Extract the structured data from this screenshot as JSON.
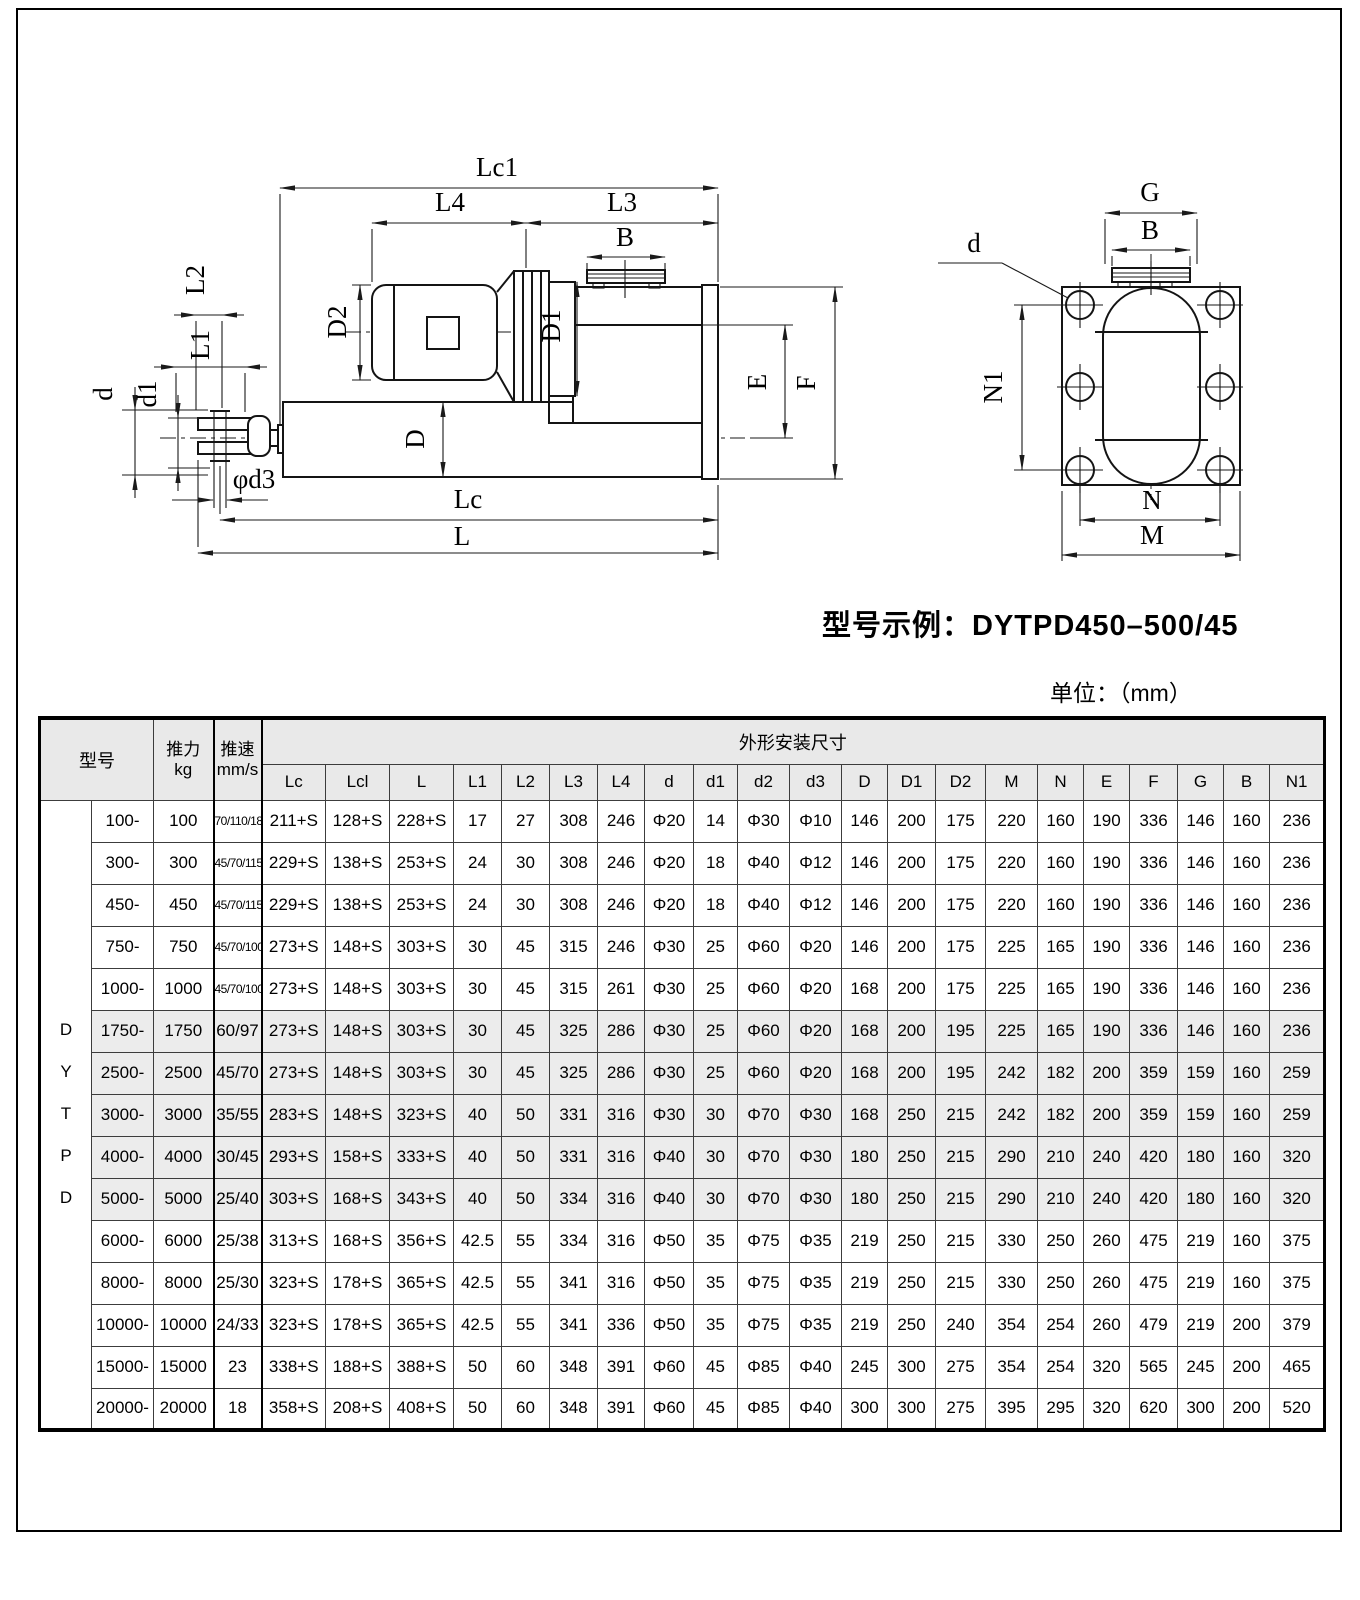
{
  "page": {
    "model_example": "型号示例：DYTPD450–500/45",
    "unit_note": "单位：（mm）"
  },
  "drawing": {
    "side": {
      "lc1": "Lc1",
      "l4": "L4",
      "l3": "L3",
      "b": "B",
      "d2": "D2",
      "dd1": "D1",
      "dd": "D",
      "l2": "L2",
      "l1": "L1",
      "d": "d",
      "d1": "d1",
      "phid3": "φd3",
      "e": "E",
      "f": "F",
      "lc": "Lc",
      "l": "L"
    },
    "end": {
      "g": "G",
      "b": "B",
      "d": "d",
      "n1": "N1",
      "n": "N",
      "m": "M"
    }
  },
  "table": {
    "series_vertical": [
      "D",
      "Y",
      "T",
      "P",
      "D"
    ],
    "headers": {
      "model": "型号",
      "thrust_line1": "推力",
      "thrust_line2": "kg",
      "speed_line1": "推速",
      "speed_line2": "mm/s",
      "dims_group": "外形安装尺寸",
      "dims": [
        "Lc",
        "Lcl",
        "L",
        "L1",
        "L2",
        "L3",
        "L4",
        "d",
        "d1",
        "d2",
        "d3",
        "D",
        "D1",
        "D2",
        "M",
        "N",
        "E",
        "F",
        "G",
        "B",
        "N1"
      ]
    },
    "rows": [
      {
        "model": "100-",
        "thrust": "100",
        "speed": "70/110/185",
        "shaded": false,
        "dims": [
          "211+S",
          "128+S",
          "228+S",
          "17",
          "27",
          "308",
          "246",
          "Φ20",
          "14",
          "Φ30",
          "Φ10",
          "146",
          "200",
          "175",
          "220",
          "160",
          "190",
          "336",
          "146",
          "160",
          "236"
        ]
      },
      {
        "model": "300-",
        "thrust": "300",
        "speed": "45/70/115",
        "shaded": false,
        "dims": [
          "229+S",
          "138+S",
          "253+S",
          "24",
          "30",
          "308",
          "246",
          "Φ20",
          "18",
          "Φ40",
          "Φ12",
          "146",
          "200",
          "175",
          "220",
          "160",
          "190",
          "336",
          "146",
          "160",
          "236"
        ]
      },
      {
        "model": "450-",
        "thrust": "450",
        "speed": "45/70/115",
        "shaded": false,
        "dims": [
          "229+S",
          "138+S",
          "253+S",
          "24",
          "30",
          "308",
          "246",
          "Φ20",
          "18",
          "Φ40",
          "Φ12",
          "146",
          "200",
          "175",
          "220",
          "160",
          "190",
          "336",
          "146",
          "160",
          "236"
        ]
      },
      {
        "model": "750-",
        "thrust": "750",
        "speed": "45/70/100",
        "shaded": false,
        "dims": [
          "273+S",
          "148+S",
          "303+S",
          "30",
          "45",
          "315",
          "246",
          "Φ30",
          "25",
          "Φ60",
          "Φ20",
          "146",
          "200",
          "175",
          "225",
          "165",
          "190",
          "336",
          "146",
          "160",
          "236"
        ]
      },
      {
        "model": "1000-",
        "thrust": "1000",
        "speed": "45/70/100",
        "shaded": false,
        "dims": [
          "273+S",
          "148+S",
          "303+S",
          "30",
          "45",
          "315",
          "261",
          "Φ30",
          "25",
          "Φ60",
          "Φ20",
          "168",
          "200",
          "175",
          "225",
          "165",
          "190",
          "336",
          "146",
          "160",
          "236"
        ]
      },
      {
        "model": "1750-",
        "thrust": "1750",
        "speed": "60/97",
        "shaded": true,
        "dims": [
          "273+S",
          "148+S",
          "303+S",
          "30",
          "45",
          "325",
          "286",
          "Φ30",
          "25",
          "Φ60",
          "Φ20",
          "168",
          "200",
          "195",
          "225",
          "165",
          "190",
          "336",
          "146",
          "160",
          "236"
        ]
      },
      {
        "model": "2500-",
        "thrust": "2500",
        "speed": "45/70",
        "shaded": true,
        "dims": [
          "273+S",
          "148+S",
          "303+S",
          "30",
          "45",
          "325",
          "286",
          "Φ30",
          "25",
          "Φ60",
          "Φ20",
          "168",
          "200",
          "195",
          "242",
          "182",
          "200",
          "359",
          "159",
          "160",
          "259"
        ]
      },
      {
        "model": "3000-",
        "thrust": "3000",
        "speed": "35/55",
        "shaded": true,
        "dims": [
          "283+S",
          "148+S",
          "323+S",
          "40",
          "50",
          "331",
          "316",
          "Φ30",
          "30",
          "Φ70",
          "Φ30",
          "168",
          "250",
          "215",
          "242",
          "182",
          "200",
          "359",
          "159",
          "160",
          "259"
        ]
      },
      {
        "model": "4000-",
        "thrust": "4000",
        "speed": "30/45",
        "shaded": true,
        "dims": [
          "293+S",
          "158+S",
          "333+S",
          "40",
          "50",
          "331",
          "316",
          "Φ40",
          "30",
          "Φ70",
          "Φ30",
          "180",
          "250",
          "215",
          "290",
          "210",
          "240",
          "420",
          "180",
          "160",
          "320"
        ]
      },
      {
        "model": "5000-",
        "thrust": "5000",
        "speed": "25/40",
        "shaded": true,
        "dims": [
          "303+S",
          "168+S",
          "343+S",
          "40",
          "50",
          "334",
          "316",
          "Φ40",
          "30",
          "Φ70",
          "Φ30",
          "180",
          "250",
          "215",
          "290",
          "210",
          "240",
          "420",
          "180",
          "160",
          "320"
        ]
      },
      {
        "model": "6000-",
        "thrust": "6000",
        "speed": "25/38",
        "shaded": false,
        "dims": [
          "313+S",
          "168+S",
          "356+S",
          "42.5",
          "55",
          "334",
          "316",
          "Φ50",
          "35",
          "Φ75",
          "Φ35",
          "219",
          "250",
          "215",
          "330",
          "250",
          "260",
          "475",
          "219",
          "160",
          "375"
        ]
      },
      {
        "model": "8000-",
        "thrust": "8000",
        "speed": "25/30",
        "shaded": false,
        "dims": [
          "323+S",
          "178+S",
          "365+S",
          "42.5",
          "55",
          "341",
          "316",
          "Φ50",
          "35",
          "Φ75",
          "Φ35",
          "219",
          "250",
          "215",
          "330",
          "250",
          "260",
          "475",
          "219",
          "160",
          "375"
        ]
      },
      {
        "model": "10000-",
        "thrust": "10000",
        "speed": "24/33",
        "shaded": false,
        "dims": [
          "323+S",
          "178+S",
          "365+S",
          "42.5",
          "55",
          "341",
          "336",
          "Φ50",
          "35",
          "Φ75",
          "Φ35",
          "219",
          "250",
          "240",
          "354",
          "254",
          "260",
          "479",
          "219",
          "200",
          "379"
        ]
      },
      {
        "model": "15000-",
        "thrust": "15000",
        "speed": "23",
        "shaded": false,
        "dims": [
          "338+S",
          "188+S",
          "388+S",
          "50",
          "60",
          "348",
          "391",
          "Φ60",
          "45",
          "Φ85",
          "Φ40",
          "245",
          "300",
          "275",
          "354",
          "254",
          "320",
          "565",
          "245",
          "200",
          "465"
        ]
      },
      {
        "model": "20000-",
        "thrust": "20000",
        "speed": "18",
        "shaded": false,
        "dims": [
          "358+S",
          "208+S",
          "408+S",
          "50",
          "60",
          "348",
          "391",
          "Φ60",
          "45",
          "Φ85",
          "Φ40",
          "300",
          "300",
          "275",
          "395",
          "295",
          "320",
          "620",
          "300",
          "200",
          "520"
        ]
      }
    ]
  }
}
